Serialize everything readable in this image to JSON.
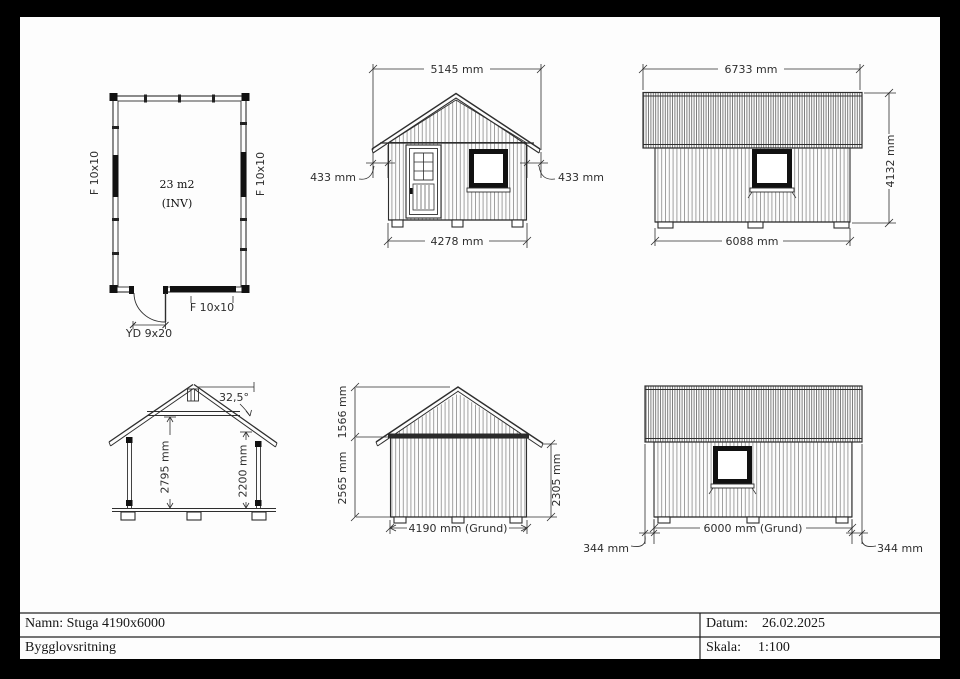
{
  "title_block": {
    "name_row": "Namn: Stuga 4190x6000",
    "type_row": "Bygglovsritning",
    "date_label": "Datum:",
    "date_value": "26.02.2025",
    "scale_label": "Skala:",
    "scale_value": "1:100"
  },
  "floor_plan": {
    "area": "23 m2",
    "area_note": "(INV)",
    "window_left": "F 10x10",
    "window_right": "F 10x10",
    "window_bottom": "F 10x10",
    "door": "YD 9x20"
  },
  "front_elevation": {
    "width_top": "5145 mm",
    "overhang_left": "433 mm",
    "overhang_right": "433 mm",
    "width_bottom": "4278 mm"
  },
  "side_elevation": {
    "width_top": "6733 mm",
    "height": "4132 mm",
    "width_bottom": "6088 mm"
  },
  "section": {
    "roof_angle": "32,5°",
    "height_ridge": "2795 mm",
    "height_wall": "2200 mm"
  },
  "rear_elevation": {
    "gable_height": "1566 mm",
    "wall_height_left": "2565 mm",
    "wall_height_right": "2305 mm",
    "width": "4190 mm (Grund)"
  },
  "side_elevation_2": {
    "width": "6000 mm (Grund)",
    "overhang_left": "344 mm",
    "overhang_right": "344 mm"
  },
  "colors": {
    "line": "#2e2e2e",
    "paper": "#fdfdfd",
    "frame": "#000000"
  }
}
